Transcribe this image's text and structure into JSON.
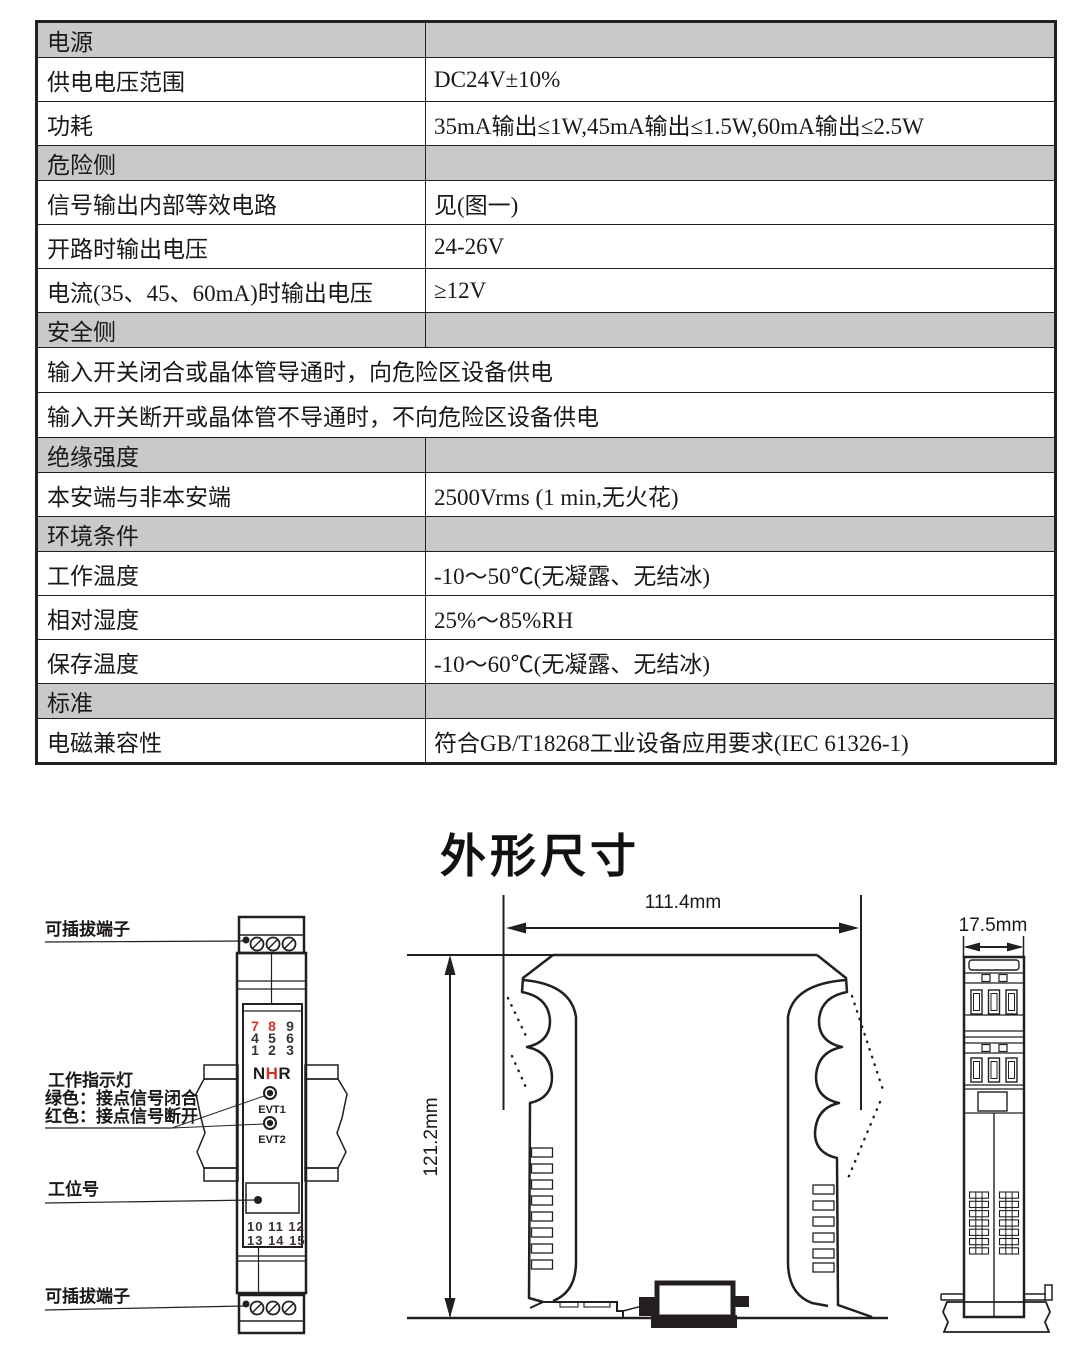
{
  "spec_table": {
    "rows": [
      {
        "type": "section",
        "label": "电源",
        "value": ""
      },
      {
        "type": "item",
        "label": "供电电压范围",
        "value": "DC24V±10%"
      },
      {
        "type": "item",
        "label": "功耗",
        "value": "35mA输出≤1W,45mA输出≤1.5W,60mA输出≤2.5W"
      },
      {
        "type": "section",
        "label": "危险侧",
        "value": ""
      },
      {
        "type": "item",
        "label": "信号输出内部等效电路",
        "value": "见(图一)"
      },
      {
        "type": "item",
        "label": "开路时输出电压",
        "value": "24-26V"
      },
      {
        "type": "item",
        "label": "电流(35、45、60mA)时输出电压",
        "value": "≥12V"
      },
      {
        "type": "section",
        "label": "安全侧",
        "value": ""
      },
      {
        "type": "full",
        "label": "输入开关闭合或晶体管导通时，向危险区设备供电",
        "value": ""
      },
      {
        "type": "full",
        "label": "输入开关断开或晶体管不导通时，不向危险区设备供电",
        "value": ""
      },
      {
        "type": "section",
        "label": "绝缘强度",
        "value": ""
      },
      {
        "type": "item",
        "label": "本安端与非本安端",
        "value": "2500Vrms (1 min,无火花)"
      },
      {
        "type": "section",
        "label": "环境条件",
        "value": ""
      },
      {
        "type": "item",
        "label": "工作温度",
        "value": "-10～50℃(无凝露、无结冰)"
      },
      {
        "type": "item",
        "label": "相对湿度",
        "value": "25%～85%RH"
      },
      {
        "type": "item",
        "label": "保存温度",
        "value": "-10～60℃(无凝露、无结冰)"
      },
      {
        "type": "section",
        "label": "标准",
        "value": ""
      },
      {
        "type": "item",
        "label": "电磁兼容性",
        "value": "符合GB/T18268工业设备应用要求(IEC 61326-1)"
      }
    ]
  },
  "dimensions_section": {
    "title": "外形尺寸",
    "front_view": {
      "callout_terminal_top": "可插拔端子",
      "callout_indicator_title": "工作指示灯",
      "callout_indicator_green": "绿色：接点信号闭合",
      "callout_indicator_red": "红色：接点信号断开",
      "callout_tag": "工位号",
      "callout_terminal_bottom": "可插拔端子",
      "top_digits": {
        "row1": [
          "7",
          "8",
          "9"
        ],
        "row2": [
          "4",
          "5",
          "6"
        ],
        "row3": [
          "1",
          "2",
          "3"
        ]
      },
      "bottom_numbers": [
        "10 11 12",
        "13 14 15"
      ],
      "brand_letters": [
        "N",
        "H",
        "R"
      ],
      "led_labels": [
        "EVT1",
        "EVT2"
      ]
    },
    "side_view": {
      "width_dim": "111.4mm",
      "height_dim": "121.2mm"
    },
    "end_view": {
      "depth_dim": "17.5mm"
    }
  },
  "colors": {
    "accent_red": "#cf3527",
    "section_gray": "#c9c9c9",
    "line_dark": "#231f20"
  }
}
